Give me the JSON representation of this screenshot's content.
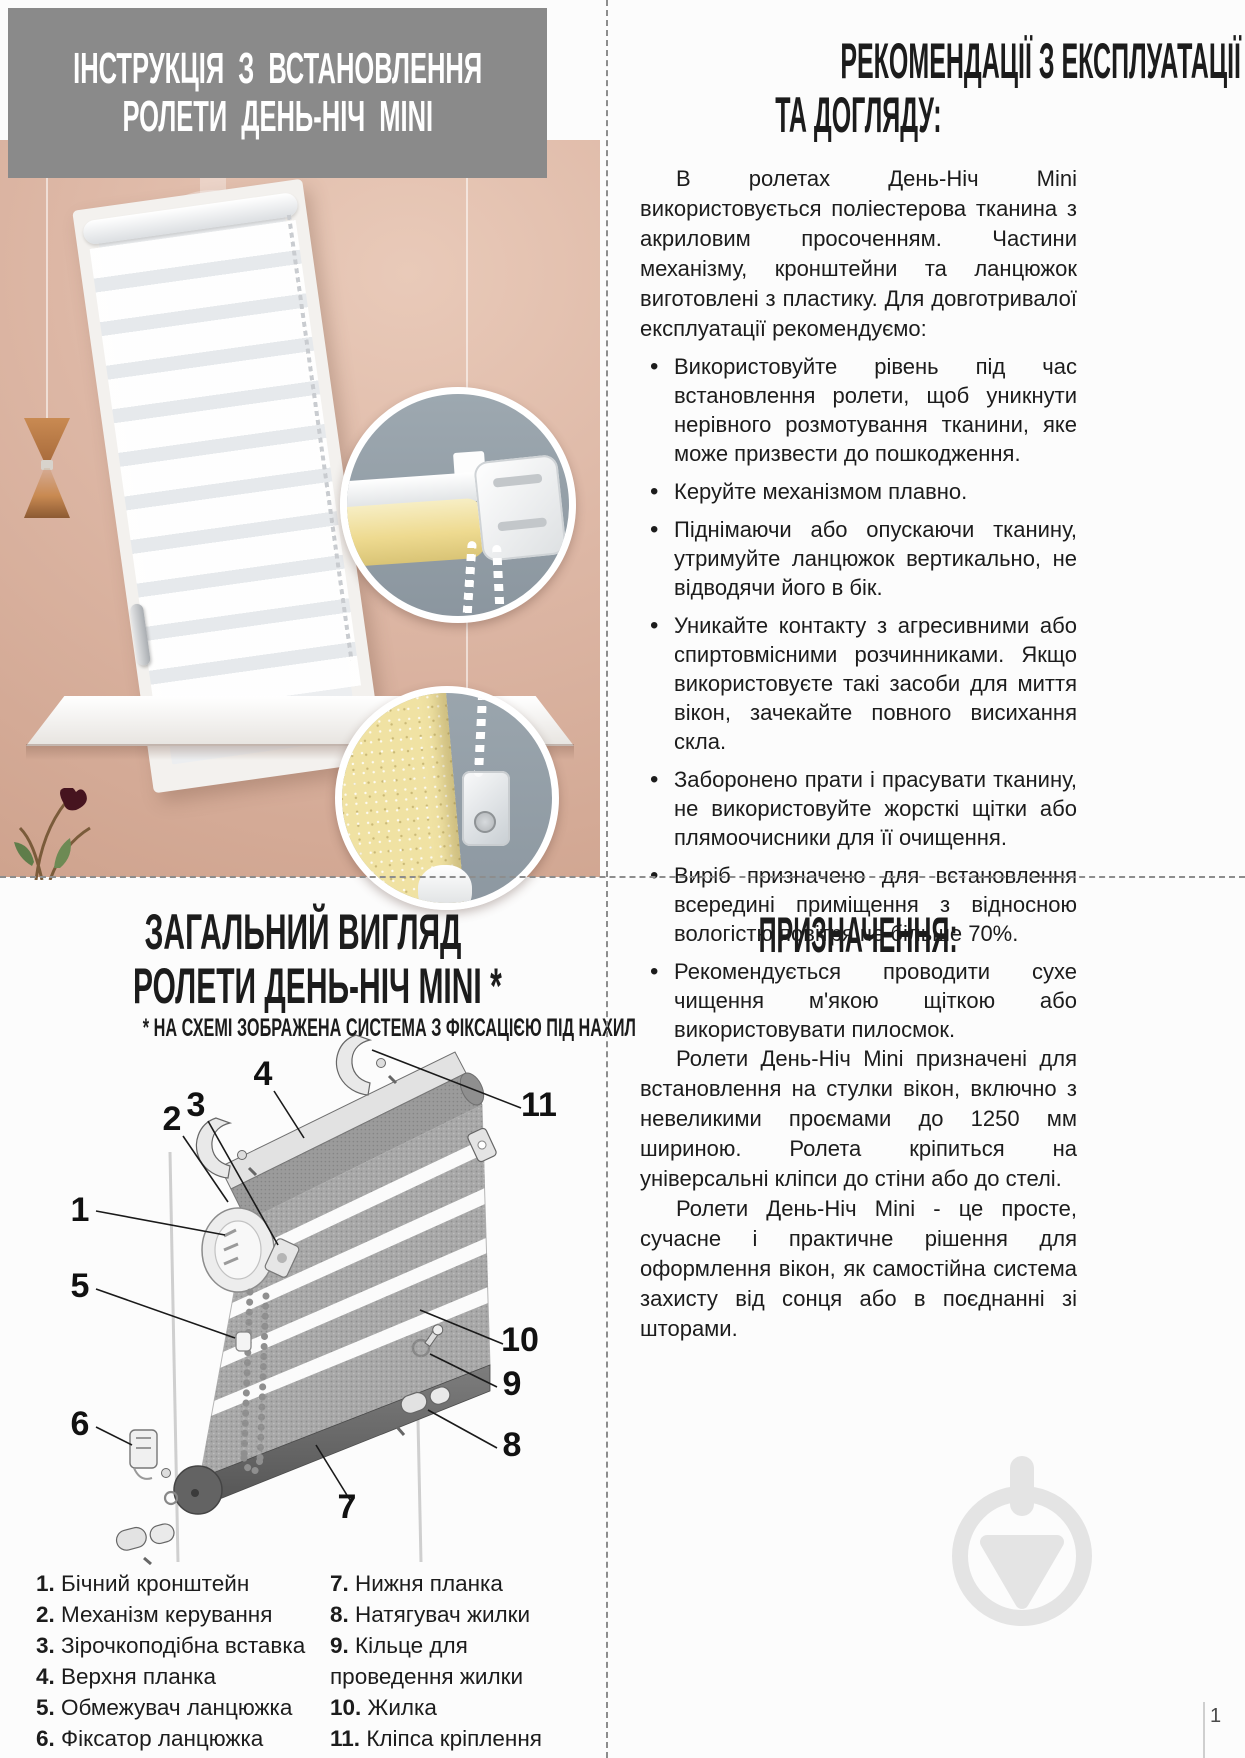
{
  "install": {
    "title_line1": "ІНСТРУКЦІЯ З ВСТАНОВЛЕННЯ",
    "title_line2": "РОЛЕТИ ДЕНЬ-НІЧ MINI"
  },
  "recommendations": {
    "title_line1": "РЕКОМЕНДАЦІЇ З ЕКСПЛУАТАЦІЇ",
    "title_line2": "ТА ДОГЛЯДУ:",
    "intro": "В ролетах День-Ніч Mini використовується поліестерова тканина з акриловим просоченням. Частини механізму, кронштейни та ланцюжок виготовлені з пластику. Для довготривалої експлуатації рекомендуємо:",
    "bullets": [
      "Використовуйте рівень під час встановлення ролети, щоб уникнути нерівного розмотування тканини, яке може призвести до пошкодження.",
      "Керуйте механізмом плавно.",
      "Піднімаючи або опускаючи тканину, утримуйте ланцюжок вертикально, не відводячи його в бік.",
      "Уникайте контакту з агресивними або спиртовмісними розчинниками. Якщо використовуєте такі засоби для миття вікон, зачекайте повного висихання скла.",
      "Заборонено прати і прасувати тканину, не використовуйте жорсткі щітки або плямоочисники для її очищення.",
      "Виріб призначено для встановлення всередині приміщення з відносною вологістю повітря не більше 70%.",
      "Рекомендується проводити сухе чищення м'якою щіткою або використовувати пилосмок."
    ]
  },
  "overview": {
    "title_line1": "ЗАГАЛЬНИЙ ВИГЛЯД",
    "title_line2": "РОЛЕТИ ДЕНЬ-НІЧ MINI *",
    "subtitle": "* НА СХЕМІ ЗОБРАЖЕНА СИСТЕМА З ФІКСАЦІЄЮ ПІД НАХИЛ",
    "callouts": {
      "c1": "1",
      "c2": "2",
      "c3": "3",
      "c4": "4",
      "c5": "5",
      "c6": "6",
      "c7": "7",
      "c8": "8",
      "c9": "9",
      "c10": "10",
      "c11": "11"
    },
    "legend_left": [
      {
        "num": "1.",
        "label": "Бічний кронштейн"
      },
      {
        "num": "2.",
        "label": "Механізм керування"
      },
      {
        "num": "3.",
        "label": "Зірочкоподібна вставка"
      },
      {
        "num": "4.",
        "label": "Верхня планка"
      },
      {
        "num": "5.",
        "label": "Обмежувач ланцюжка"
      },
      {
        "num": "6.",
        "label": "Фіксатор ланцюжка"
      }
    ],
    "legend_right": [
      {
        "num": "7.",
        "label": "Нижня планка"
      },
      {
        "num": "8.",
        "label": "Натягувач жилки"
      },
      {
        "num": "9.",
        "label": "Кільце для проведення жилки"
      },
      {
        "num": "10.",
        "label": "Жилка"
      },
      {
        "num": "11.",
        "label": "Кліпса кріплення"
      }
    ]
  },
  "purpose": {
    "title": "ПРИЗНАЧЕННЯ:",
    "paragraphs": [
      "Ролети День-Ніч Mini призначені для встановлення на стулки вікон, включно з невеликими проємами до 1250 мм шириною. Ролета кріпиться на універсальні кліпси до стіни або до стелі.",
      "Ролети День-Ніч Mini - це просте, сучасне і практичне рішення для оформлення вікон, як самостійна система захисту від сонця або в поєднанні зі шторами."
    ]
  },
  "page": {
    "number": "1"
  },
  "colors": {
    "banner_gray": "#8a8a8a",
    "wall_pink": "#ddb7a5",
    "roller_yellow": "#efe1a0",
    "inset_gray": "#97a2aa",
    "watermark_gray": "#e4e4e4"
  }
}
